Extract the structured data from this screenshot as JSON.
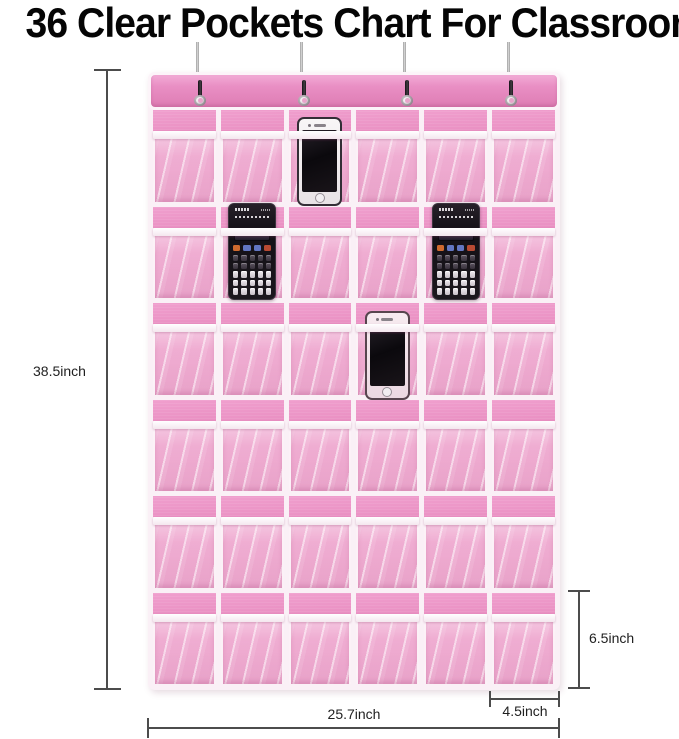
{
  "title": "36 Clear Pockets Chart For Classroom",
  "dimension_labels": {
    "overall_height": "38.5inch",
    "overall_width": "25.7inch",
    "pocket_width": "4.5inch",
    "pocket_height": "6.5inch"
  },
  "organizer": {
    "pocket_rows": 6,
    "pocket_cols": 6,
    "pocket_count": 36,
    "hook_count": 4,
    "colors": {
      "fabric": "#e585ba",
      "fabric_deep": "#dd76ad",
      "band": "#e98fc4",
      "trim": "#faf0f6",
      "vinyl": "#eb9cc8"
    },
    "items": [
      {
        "type": "smartphone",
        "variant": "silver",
        "row": 1,
        "col": 3
      },
      {
        "type": "calculator",
        "variant": "black",
        "row": 2,
        "col": 2
      },
      {
        "type": "calculator",
        "variant": "black",
        "row": 2,
        "col": 5
      },
      {
        "type": "smartphone",
        "variant": "rose",
        "row": 3,
        "col": 4
      }
    ]
  }
}
